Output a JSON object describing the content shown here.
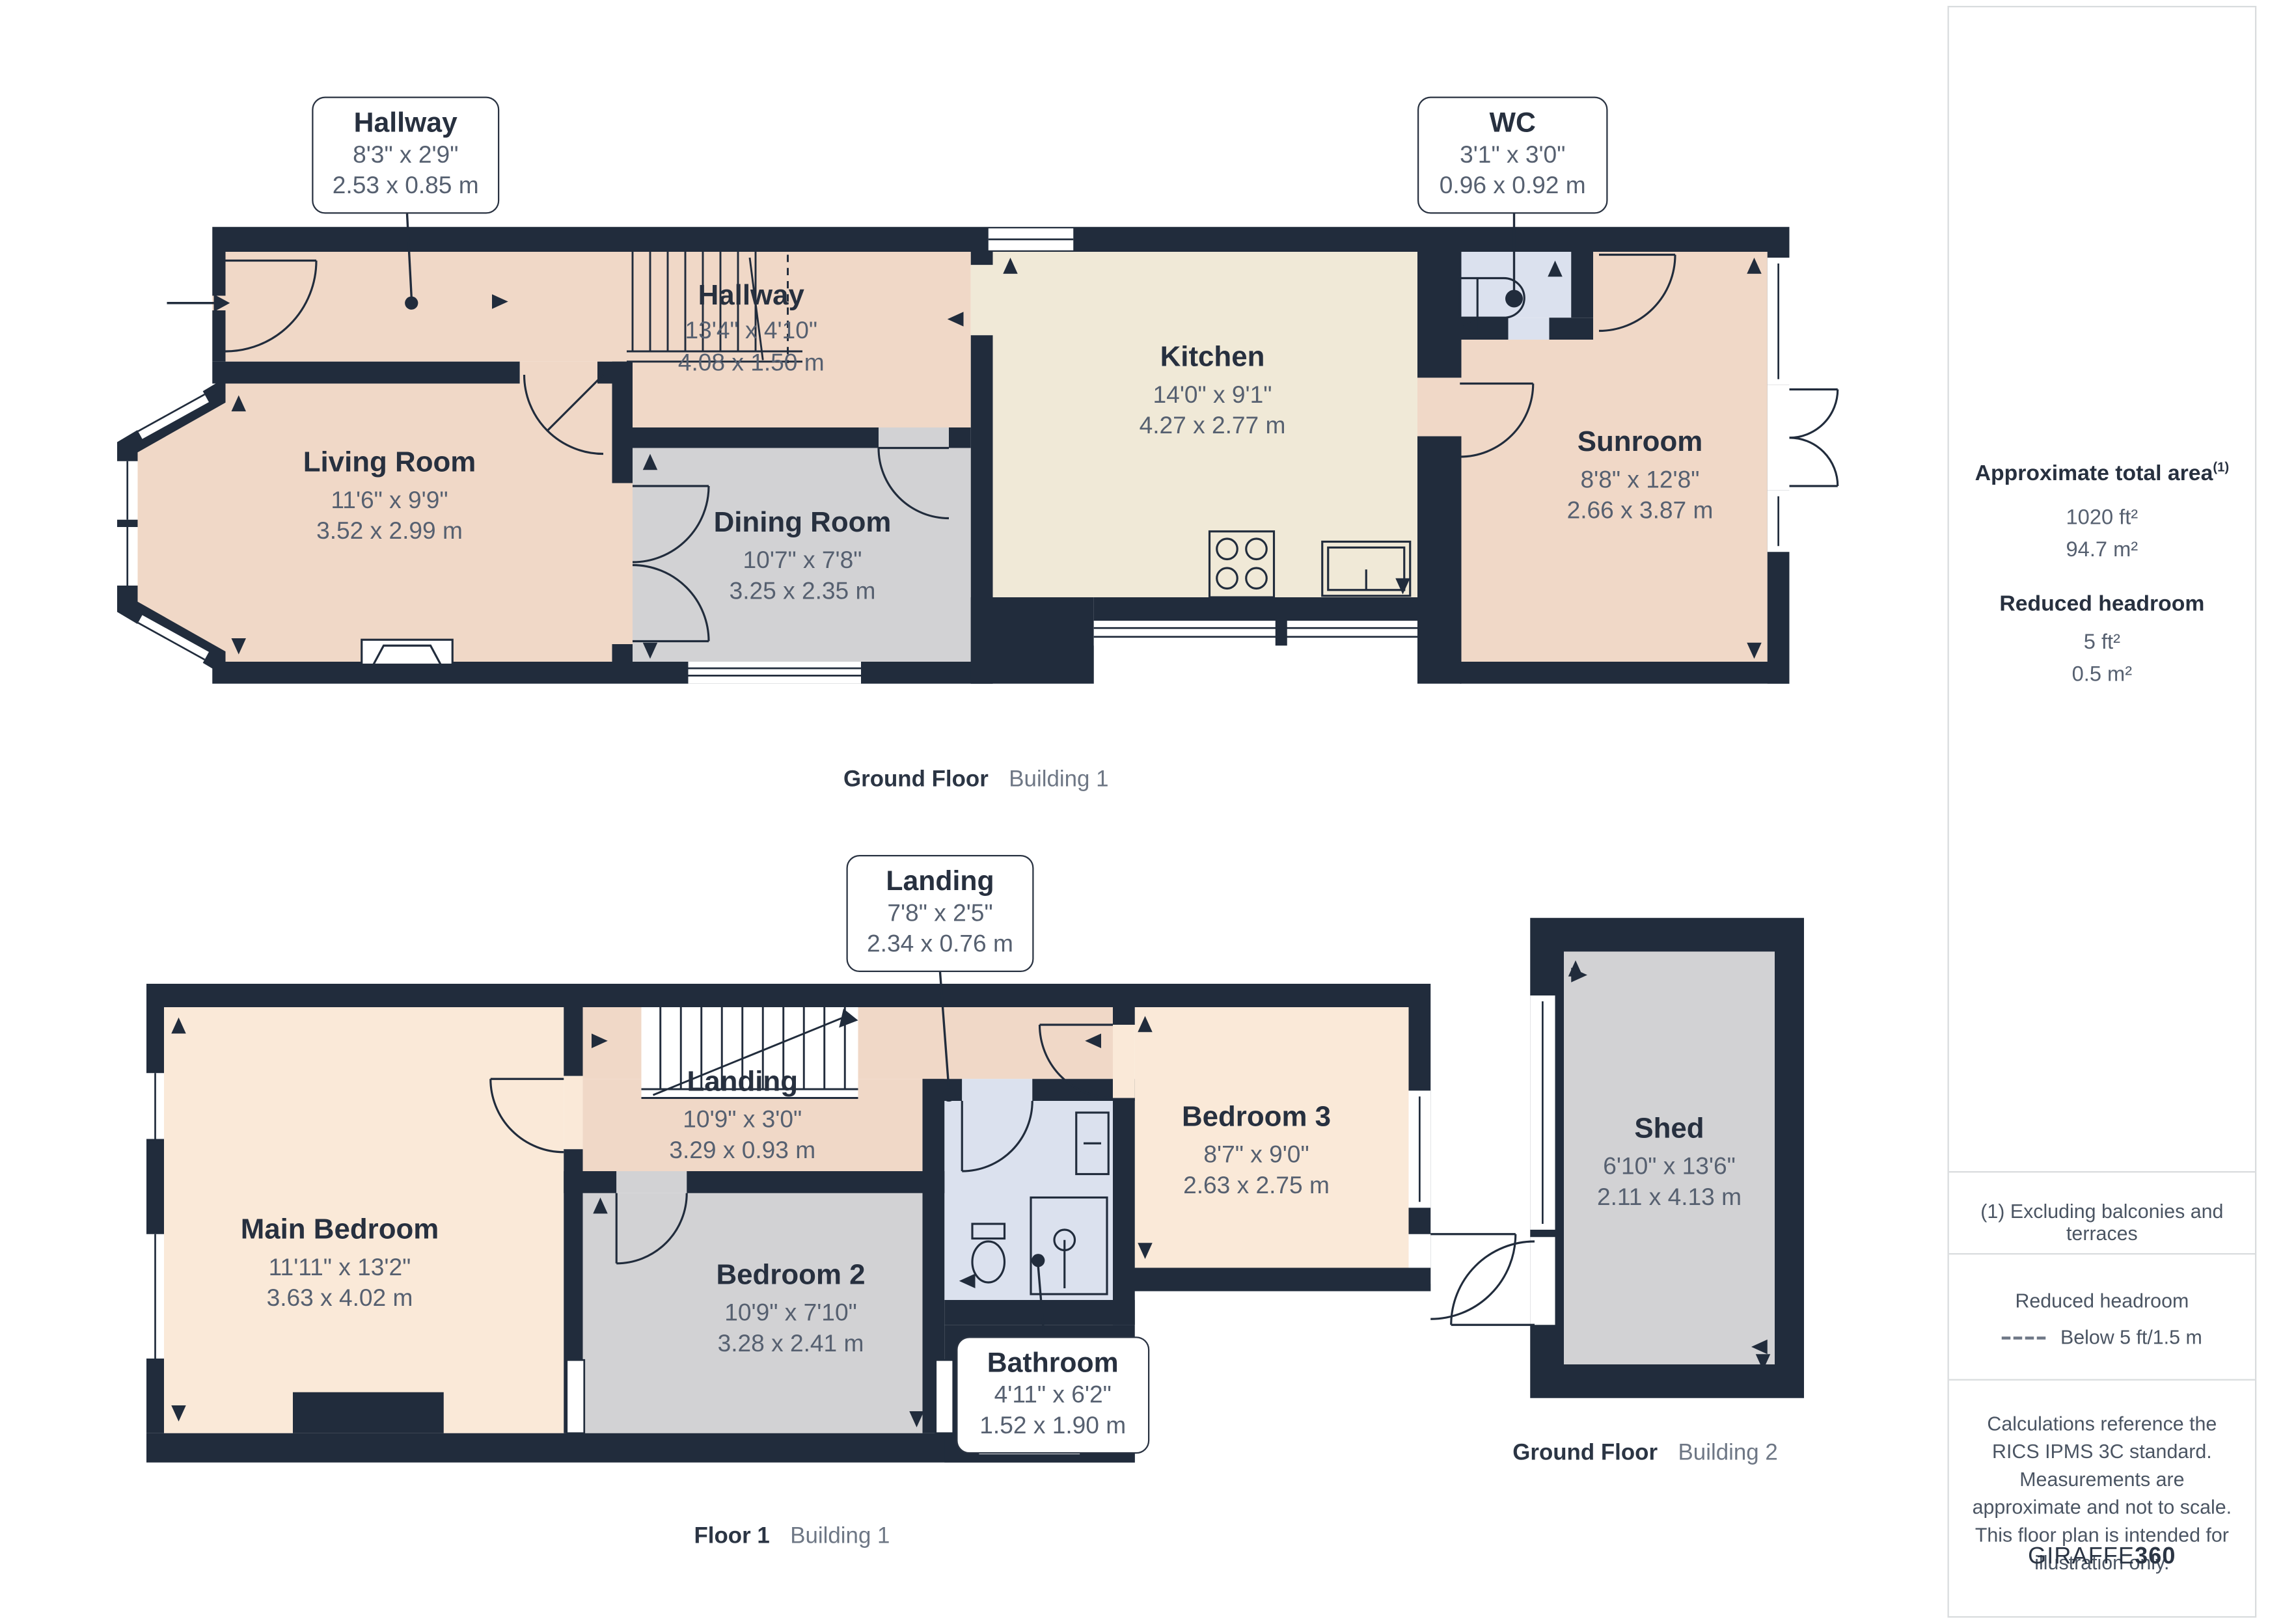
{
  "plan": {
    "ground_floor_b1": {
      "rooms": [
        {
          "name": "Hallway",
          "imperial": "13'4\" x 4'10\"",
          "metric": "4.08 x 1.50 m"
        },
        {
          "name": "Living Room",
          "imperial": "11'6\" x 9'9\"",
          "metric": "3.52 x 2.99 m"
        },
        {
          "name": "Dining Room",
          "imperial": "10'7\" x 7'8\"",
          "metric": "3.25 x 2.35 m"
        },
        {
          "name": "Kitchen",
          "imperial": "14'0\" x 9'1\"",
          "metric": "4.27 x 2.77 m"
        },
        {
          "name": "Sunroom",
          "imperial": "8'8\" x 12'8\"",
          "metric": "2.66 x 3.87 m"
        }
      ],
      "label": {
        "floor": "Ground Floor",
        "building": "Building 1"
      }
    },
    "floor1_b1": {
      "rooms": [
        {
          "name": "Main Bedroom",
          "imperial": "11'11\" x 13'2\"",
          "metric": "3.63 x 4.02 m"
        },
        {
          "name": "Landing",
          "imperial": "10'9\" x 3'0\"",
          "metric": "3.29 x 0.93 m"
        },
        {
          "name": "Bedroom 2",
          "imperial": "10'9\" x 7'10\"",
          "metric": "3.28 x 2.41 m"
        },
        {
          "name": "Bedroom 3",
          "imperial": "8'7\" x 9'0\"",
          "metric": "2.63 x 2.75 m"
        }
      ],
      "label": {
        "floor": "Floor 1",
        "building": "Building 1"
      }
    },
    "ground_floor_b2": {
      "rooms": [
        {
          "name": "Shed",
          "imperial": "6'10\" x 13'6\"",
          "metric": "2.11 x 4.13 m"
        }
      ],
      "label": {
        "floor": "Ground Floor",
        "building": "Building 2"
      }
    },
    "callouts": [
      {
        "name": "Hallway",
        "imperial": "8'3\" x 2'9\"",
        "metric": "2.53 x 0.85 m"
      },
      {
        "name": "WC",
        "imperial": "3'1\" x 3'0\"",
        "metric": "0.96 x 0.92 m"
      },
      {
        "name": "Landing",
        "imperial": "7'8\" x 2'5\"",
        "metric": "2.34 x 0.76 m"
      },
      {
        "name": "Bathroom",
        "imperial": "4'11\" x 6'2\"",
        "metric": "1.52 x 1.90 m"
      }
    ],
    "colors": {
      "wall": "#212c3c",
      "peach": "#f0d8c7",
      "light_peach": "#fae9d8",
      "cream": "#f0e9d7",
      "gray": "#d2d2d4",
      "blue": "#dbe1ee"
    }
  },
  "sidebar": {
    "area_title": "Approximate total area",
    "area_sup": "(1)",
    "area_ft": "1020 ft²",
    "area_m": "94.7 m²",
    "headroom_title": "Reduced headroom",
    "headroom_ft": "5 ft²",
    "headroom_m": "0.5 m²",
    "note1": "(1) Excluding balconies and terraces",
    "legend_title": "Reduced headroom",
    "legend_value": "Below 5 ft/1.5 m",
    "disclaimer": "Calculations reference the RICS IPMS 3C standard. Measurements are approximate and not to scale. This floor plan is intended for illustration only.",
    "logo_a": "GIRAFFE",
    "logo_b": "360"
  }
}
